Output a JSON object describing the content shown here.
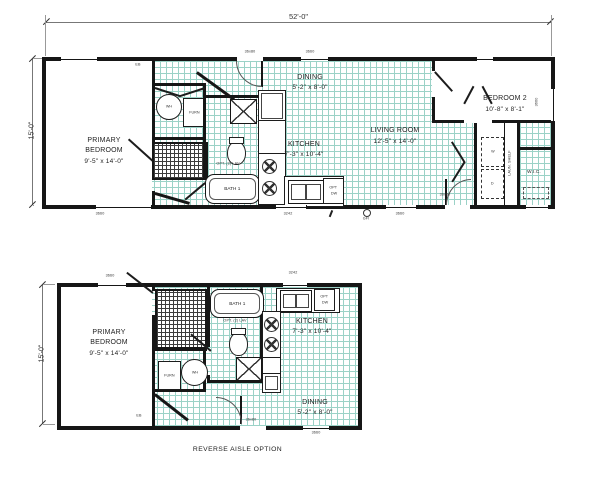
{
  "caption": "REVERSE AISLE OPTION",
  "overall_dims": {
    "width": "52'-0\"",
    "height": "15'-0\""
  },
  "rooms": {
    "primary_bedroom": {
      "name_line1": "PRIMARY",
      "name_line2": "BEDROOM",
      "size": "9'-5\" x 14'-0\""
    },
    "bath1": {
      "name": "BATH 1",
      "opt_note": "OPT. (2) LAV"
    },
    "kitchen": {
      "name": "KITCHEN",
      "size": "7'-3\" x 10'-4\"",
      "opt_dw_line1": "OPT",
      "opt_dw_line2": "DW"
    },
    "dining": {
      "name": "DINING",
      "size": "5'-2\" x 8'-0\""
    },
    "living_room": {
      "name": "LIVING ROOM",
      "size": "12'-5\" x 14'-0\""
    },
    "bedroom2": {
      "name": "BEDROOM 2",
      "size": "10'-8\" x 8'-1\""
    },
    "wic": {
      "name": "W.I.C."
    }
  },
  "equipment": {
    "water_heater": "WH",
    "furnace": "FURN",
    "washer": "W",
    "dryer": "D",
    "laundry_shelf": "LAUN. SHELF"
  },
  "openings": {
    "entry_door": "36x80",
    "window_large": "3660",
    "window_kitchen": "3242",
    "elec_box": "EB",
    "gfi": "GFI"
  },
  "colors": {
    "wall": "#161616",
    "tile_grid": "#9bd2c7",
    "annotation": "#333333"
  }
}
